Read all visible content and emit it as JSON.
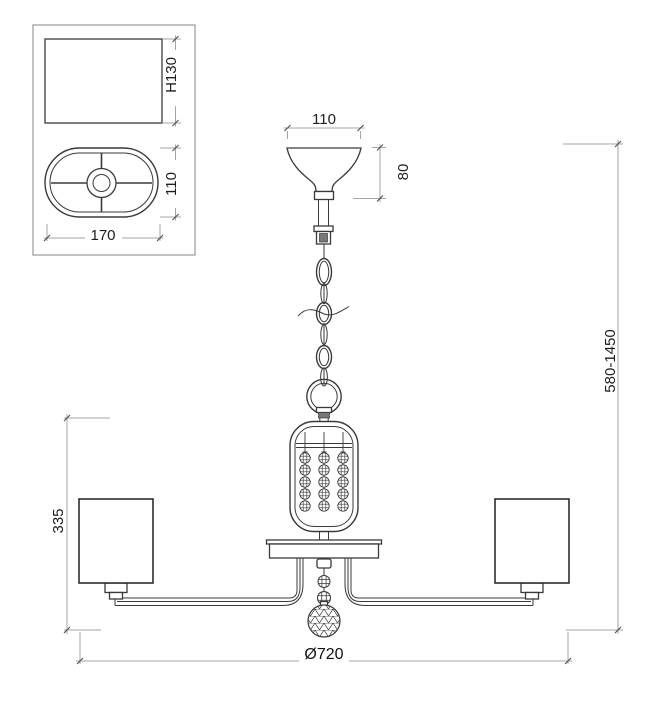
{
  "detail_view": {
    "height_label": "H130",
    "depth_label": "110",
    "width_label": "170"
  },
  "main_view": {
    "canopy_width_label": "110",
    "canopy_height_label": "80",
    "suspension_height_label": "580-1450",
    "body_height_label": "335",
    "diameter_label": "Ø720"
  },
  "colors": {
    "object_line": "#3a3a3a",
    "dimension_line": "#a6a6a6",
    "text": "#1d1d1d",
    "background": "#ffffff"
  }
}
